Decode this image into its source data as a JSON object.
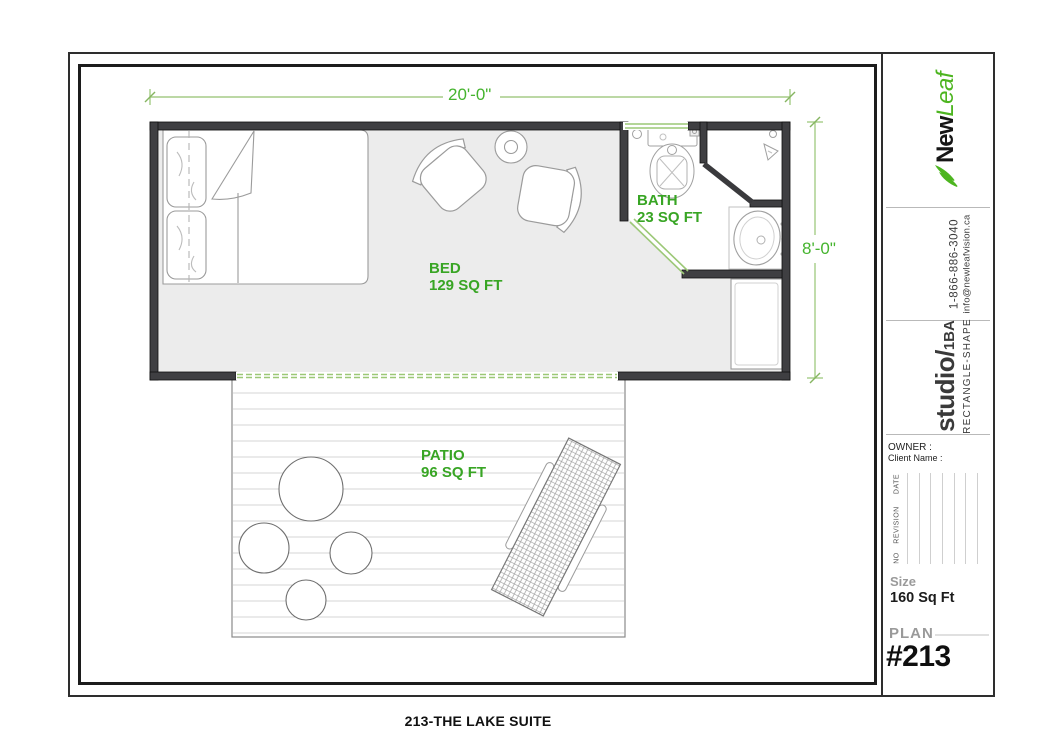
{
  "page": {
    "caption": "213-THE LAKE SUITE"
  },
  "title_block": {
    "brand": {
      "name_black": "New",
      "name_green": "Leaf"
    },
    "contact": {
      "phone": "1-866-886-3040",
      "email": "info@newleafvision.ca"
    },
    "studio": {
      "main": "studio/",
      "suffix": "1BA",
      "shape": "RECTANGLE-SHAPE"
    },
    "owner": {
      "owner_label": "OWNER :",
      "client_label": "Client Name :"
    },
    "revision_table": {
      "columns": [
        "NO",
        "REVISION",
        "DATE"
      ]
    },
    "size": {
      "label": "Size",
      "value": "160 Sq Ft"
    },
    "plan": {
      "label": "PLAN",
      "number": "#213"
    }
  },
  "floor_plan": {
    "rooms": [
      {
        "name": "BED",
        "area": "129 SQ FT"
      },
      {
        "name": "BATH",
        "area": "23 SQ FT"
      },
      {
        "name": "PATIO",
        "area": "96 SQ FT"
      }
    ],
    "dimensions": {
      "width": "20'-0\"",
      "height": "8'-0\""
    },
    "colors": {
      "accent_green": "#38a524",
      "dim_green": "#45b42e",
      "door_window_green": "#9cc877",
      "wall": "#3f3f42",
      "interior_gray": "#ececec",
      "logo_green": "#4db520"
    }
  }
}
